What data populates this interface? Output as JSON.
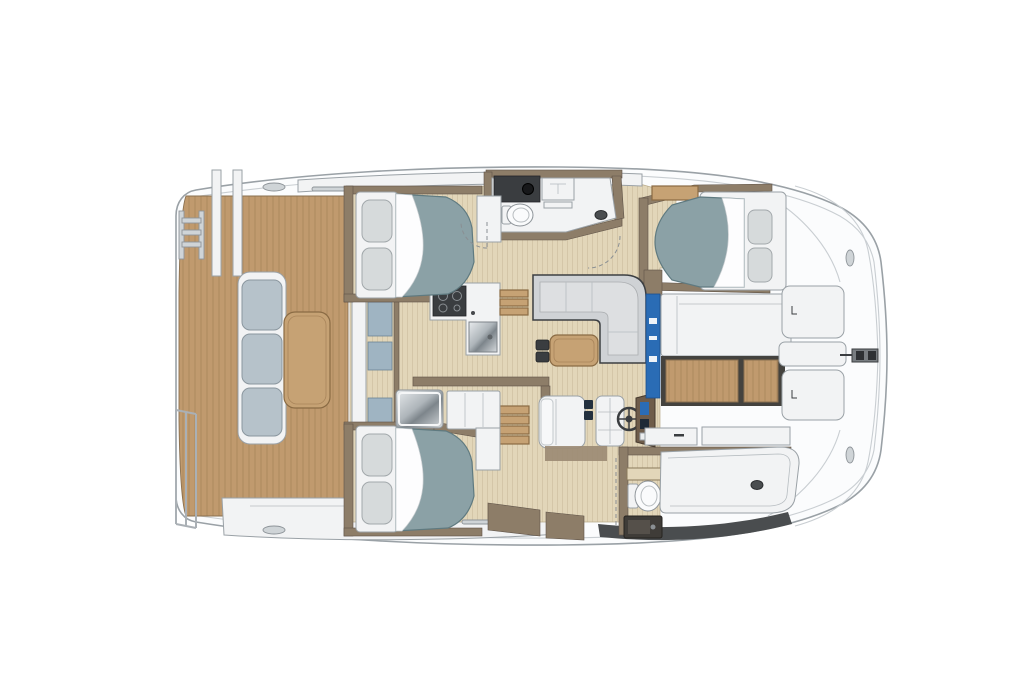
{
  "image": {
    "kind": "catamaran-interior-floor-plan",
    "orientation": "bow-right-stern-left",
    "visible_text": []
  },
  "colors": {
    "hull-white": "#fbfcfd",
    "hull-outline": "#9aa1a6",
    "seam": "#c9ced2",
    "teak": "#c09a6e",
    "teak-line": "#9d7c52",
    "teak-edge": "#8a7050",
    "sole": "#e2d6b9",
    "sole-line": "#cdbd9d",
    "wall": "#8d7d68",
    "wall-dark": "#5f5348",
    "mattress": "#8ba1a6",
    "mattress-edge": "#5f7a80",
    "pillow": "#d6dadb",
    "sofa": "#cfd2d5",
    "sofa-edge": "#3c3f42",
    "cushion": "#b6c2ca",
    "wood": "#c6a274",
    "wood-edge": "#8a6b44",
    "dark-fixture": "#3a3d40",
    "accent-blue": "#2a6cb5",
    "glass-blue": "#9fb4c2",
    "hull-strip": "#4a4d4f",
    "white-fixture": "#f2f3f4"
  },
  "regions": [
    "swim-platform",
    "swim-ladder",
    "stern-rail",
    "aft-cockpit-deck",
    "cockpit-bench",
    "cockpit-table",
    "aft-sliding-door",
    "port-aft-cabin-bed",
    "starboard-aft-cabin-bed",
    "port-head-bathroom",
    "galley-counter",
    "stove",
    "sink",
    "companionway-steps",
    "saloon-settee",
    "saloon-table",
    "nav-seat",
    "helm-seat",
    "steering-wheel",
    "helm-console",
    "starboard-head-toilet",
    "shower-tray",
    "forward-cabin-bed",
    "forward-cockpit-bench",
    "forward-cockpit-teak",
    "foredeck-hatch",
    "anchor-fitting"
  ]
}
